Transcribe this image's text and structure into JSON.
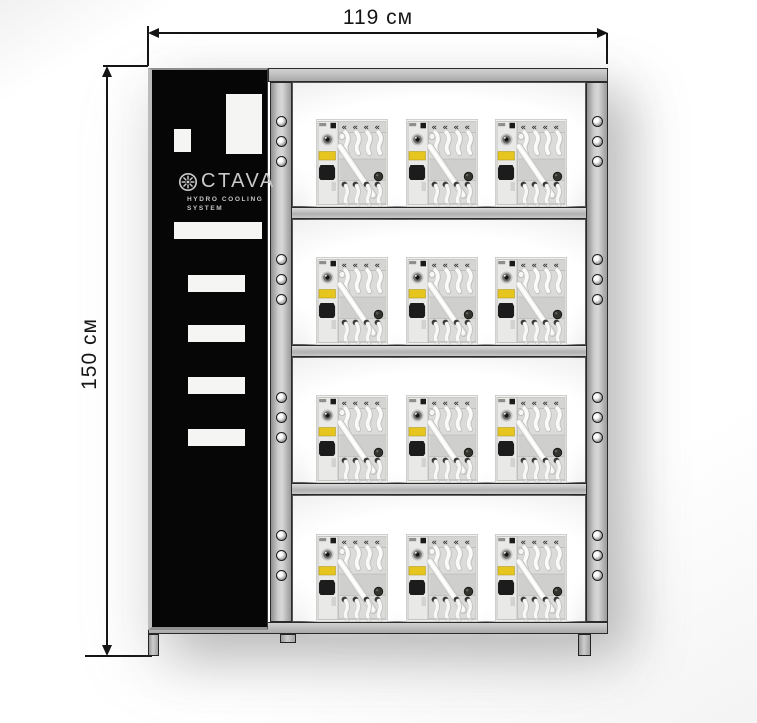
{
  "title": "OCTAVA hydro cooling system rack — dimension diagram",
  "dimensions": {
    "width_label": "119 см",
    "height_label": "150 см"
  },
  "panel": {
    "brand_icon": "impeller-gear-icon",
    "brand_text": "CTAVA",
    "subtitle_line1": "HYDRO COOLING",
    "subtitle_line2": "SYSTEM"
  },
  "rack": {
    "shelf_rows": 4,
    "units_per_row": 3,
    "unit_icon": "cooling-unit-rear-view",
    "holes_per_post_section": 3
  },
  "colors": {
    "frame_gray": "#b9b9b9",
    "panel_black": "#060606",
    "unit_label_yellow": "#e7c51f",
    "dimension_line": "#141414",
    "brand_text_gray": "#c9c9c9"
  }
}
